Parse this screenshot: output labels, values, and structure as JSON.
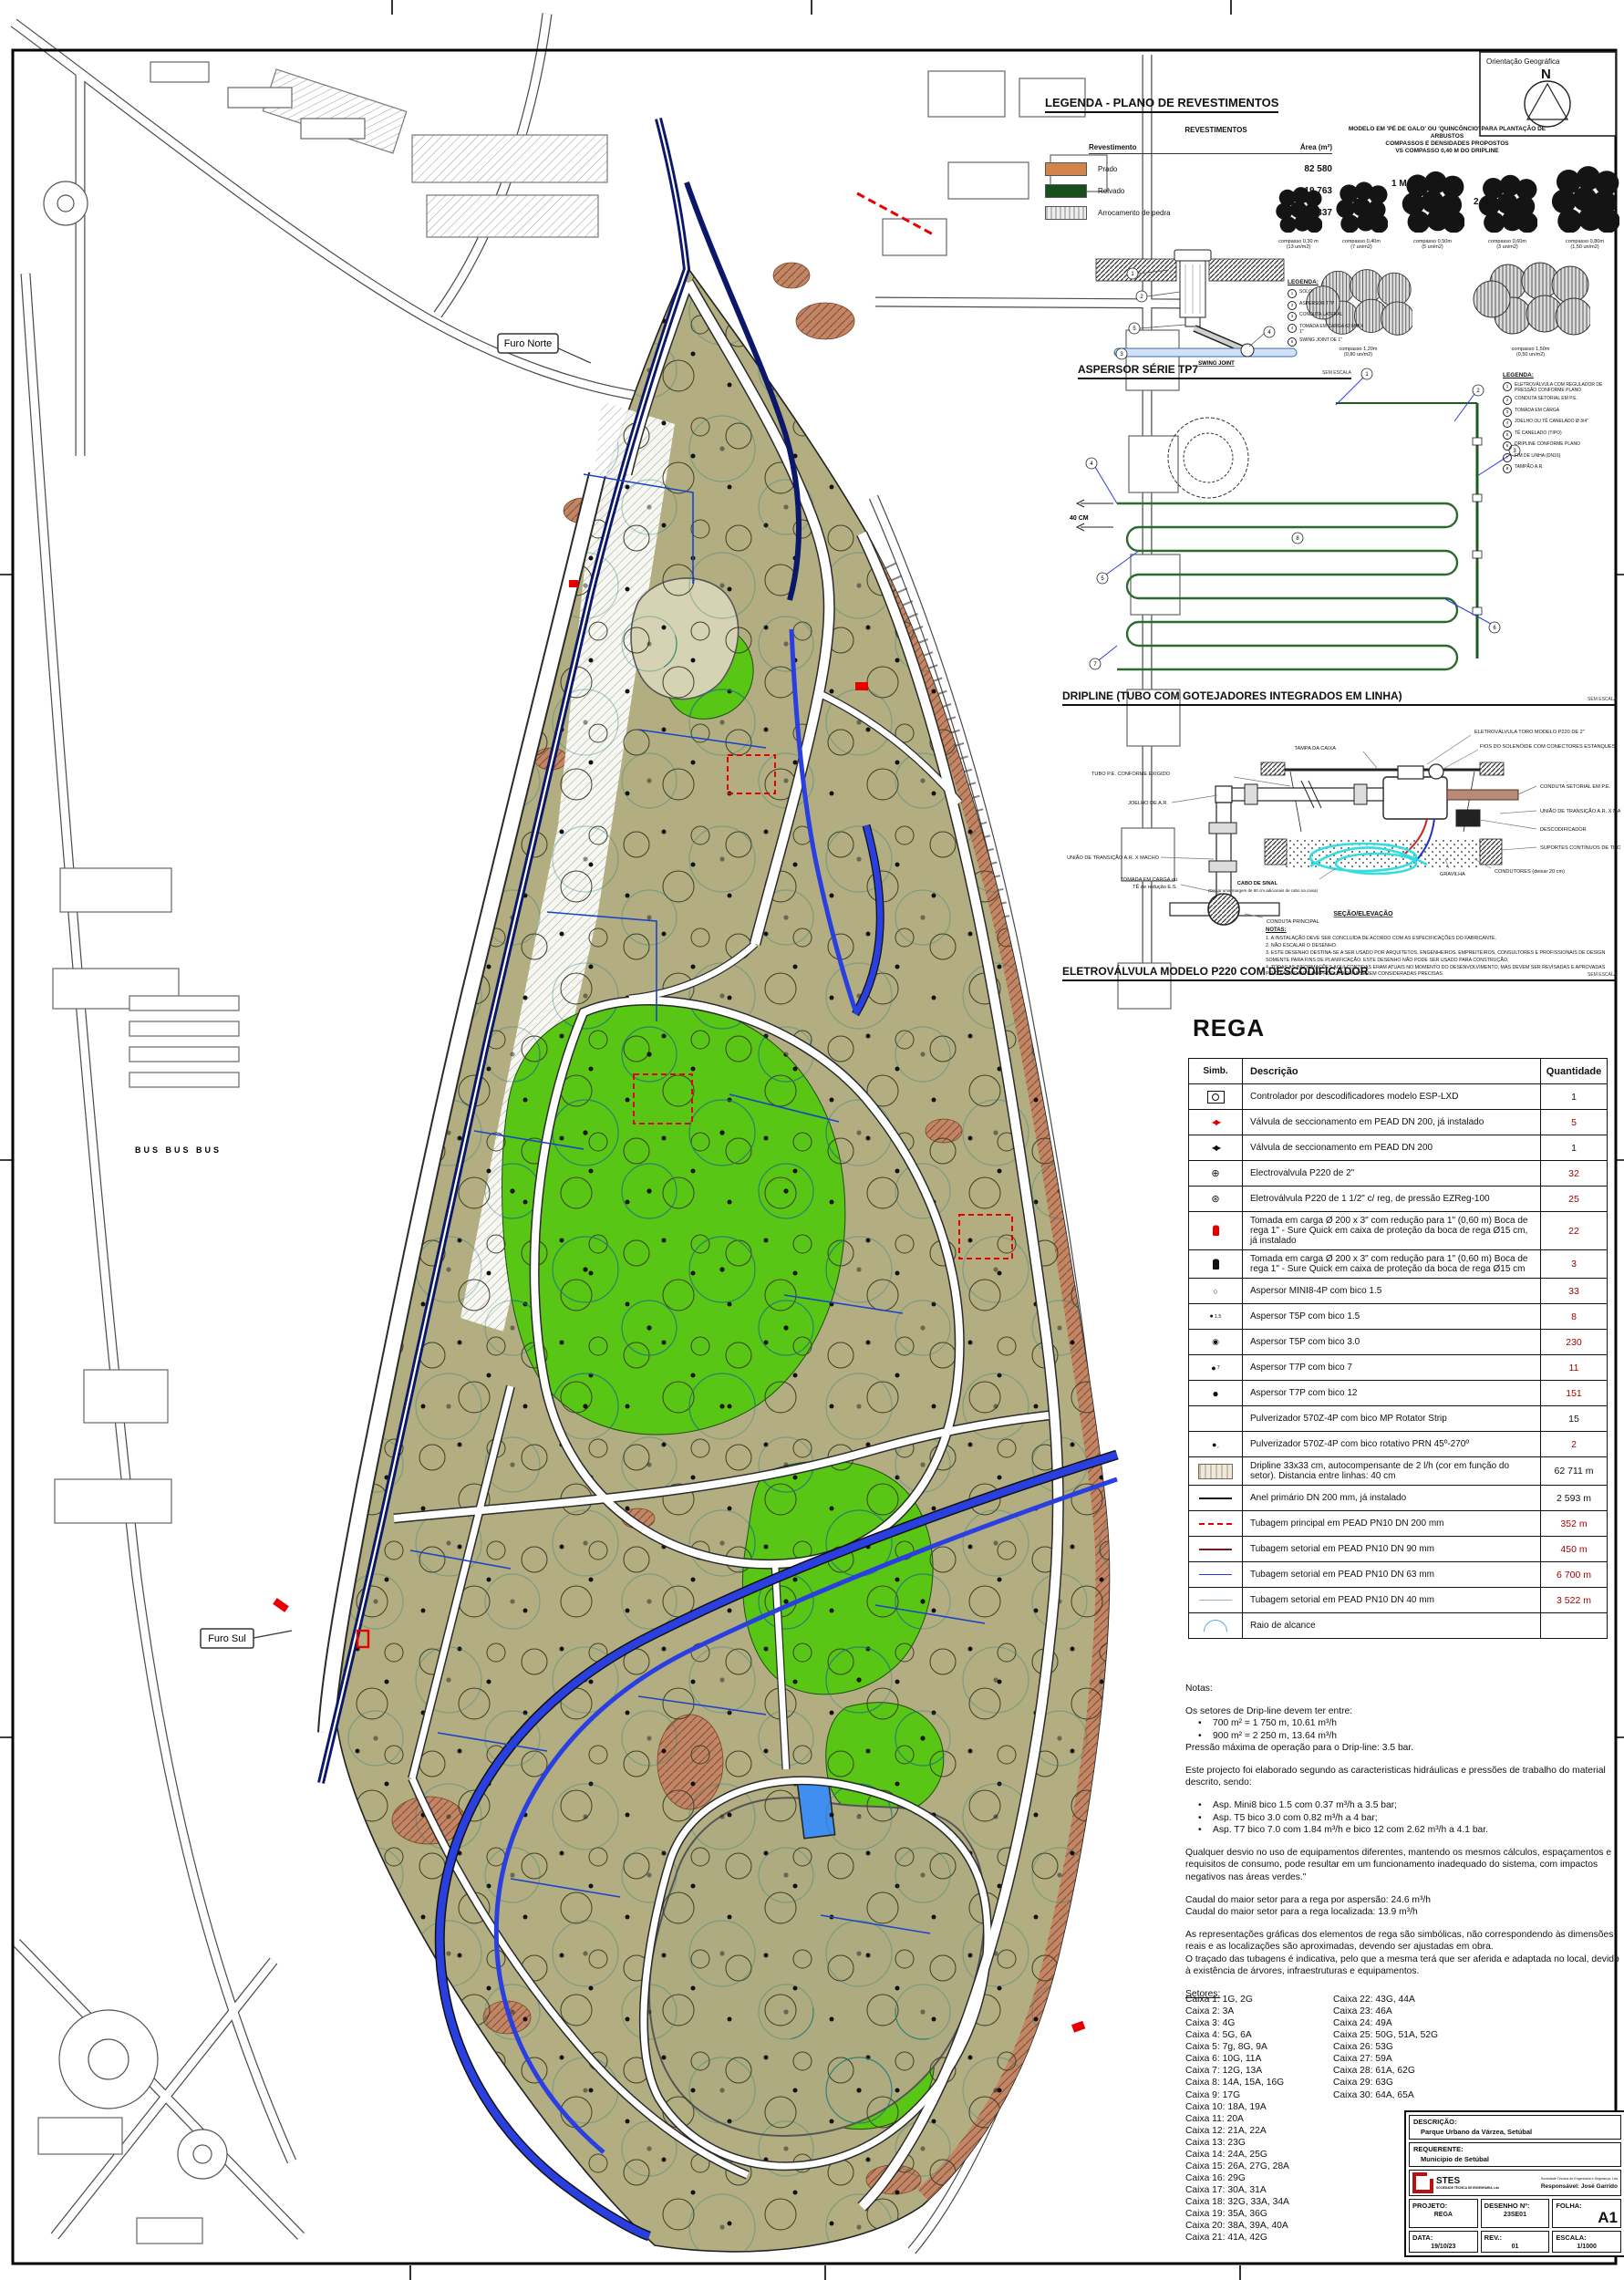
{
  "colors": {
    "olive": "#b2ae82",
    "relvado": "#59c515",
    "pipe_blue": "#2a3fe0",
    "anel_navy": "#0b1768",
    "tan": "#c08666",
    "teal": "#1f7a74",
    "red": "#e80000",
    "qty_red": "#a80000"
  },
  "map": {
    "furo_norte": "Furo Norte",
    "furo_sul": "Furo Sul",
    "bus": "BUS  BUS  BUS"
  },
  "compass": {
    "title": "Orientação Geográfica",
    "n": "N"
  },
  "legenda_rev": {
    "title": "LEGENDA - PLANO DE REVESTIMENTOS",
    "table_title": "REVESTIMENTOS",
    "col1": "Revestimento",
    "col2": "Área (m²)",
    "rows": [
      {
        "sw": "prado",
        "name": "Prado",
        "area": "82 580"
      },
      {
        "sw": "relvado",
        "name": "Relvado",
        "area": "19 763"
      },
      {
        "sw": "pedra",
        "name": "Arrocamento de pedra",
        "area": "6 337"
      }
    ]
  },
  "plant": {
    "title1": "MODELO  EM 'PÉ DE GALO' OU 'QUINCÔNCIO' PARA PLANTAÇÃO DE",
    "title2": "ARBUSTOS",
    "title3": "COMPASSOS E DENSIDADES PROPOSTOS",
    "title4": "VS COMPASSO 0,40 M DO DRIPLINE",
    "dim1": "1 M",
    "dim2": "2 M",
    "row1": [
      {
        "c": "compasso 0,30 m",
        "d": "(13 un/m2)",
        "w": "52"
      },
      {
        "c": "compasso 0,40m",
        "d": "(7 un/m2)",
        "w": "58"
      },
      {
        "c": "compasso 0,50m",
        "d": "(5 un/m2)",
        "w": "70"
      },
      {
        "c": "compasso 0,60m",
        "d": "(3 un/m2)",
        "w": "66"
      },
      {
        "c": "compasso 0,80m",
        "d": "(1,50 un/m2)",
        "w": "76"
      }
    ],
    "row2": [
      {
        "c": "compasso 1,20m",
        "d": "(0,80 un/m2)",
        "w": "118"
      },
      {
        "c": "compasso 1,50m",
        "d": "(0,50 un/m2)",
        "w": "130"
      }
    ]
  },
  "aspersor": {
    "title": "ASPERSOR SÉRIE TP7",
    "legend_title": "LEGENDA:",
    "swing": "SWING JOINT",
    "scale": "SEM ESCALA",
    "items": [
      {
        "n": "1",
        "t": "SOLO"
      },
      {
        "n": "2",
        "t": "ASPERSOR T7P"
      },
      {
        "n": "3",
        "t": "CONDUTA LATERAL"
      },
      {
        "n": "4",
        "t": "TOMADA EM CARGA 63 MM X 1\""
      },
      {
        "n": "5",
        "t": "SWING JOINT DE 1\""
      }
    ]
  },
  "dripline": {
    "title": "DRIPLINE  (TUBO COM GOTEJADORES INTEGRADOS EM LINHA)",
    "legend_title": "LEGENDA:",
    "dim": "40 CM",
    "scale": "SEM ESCALA",
    "items": [
      {
        "n": "1",
        "t": "ELETROVÁLVULA COM REGULADOR DE PRESSÃO CONFORME PLANO"
      },
      {
        "n": "2",
        "t": "CONDUTA SETORIAL EM P.E."
      },
      {
        "n": "3",
        "t": "TOMADA EM CARGA"
      },
      {
        "n": "4",
        "t": "JOELHO OU TÊ CANELADO Ø 3/4\""
      },
      {
        "n": "5",
        "t": "TÊ CANELADO (TIPO)"
      },
      {
        "n": "6",
        "t": "DRIPLINE CONFORME PLANO"
      },
      {
        "n": "7",
        "t": "FIM DE LINHA (DN16)"
      },
      {
        "n": "8",
        "t": "TAMPÃO A.R."
      }
    ]
  },
  "valve": {
    "title": "ELETROVÁLVULA MODELO P220 COM DESCODIFICADOR",
    "scale": "SEM ESCALA",
    "labels": [
      "TAMPA DA CAIXA",
      "ELETROVÁLVULA TORO  MODELO P220 DE 2\"",
      "FIOS DO SOLENÓIDE COM CONECTORES ESTANQUES",
      "TUBO P.E. CONFORME EXIGIDO",
      "JOELHO DE A.R.",
      "UNIÃO DE TRANSIÇÃO A.R. X MACHO",
      "TOMADA EM CARGA ou",
      "TÊ de redução E.S.",
      "CONDUTA PRINCIPAL",
      "CONDUTA SETORIAL EM P.E.",
      "UNIÃO DE TRANSIÇÃO A.R. X MACHO",
      "DESCODIFICADOR",
      "SUPORTES CONTÍNUOS DE TIJOLO",
      "CONDUTORES (deixar 20 cm)",
      "GRAVILHA",
      "CABO DE SINAL",
      "(Deixar uma margem de 80 cm adicionais de cabo na caixa)",
      "SEÇÃO/ELEVAÇÃO"
    ],
    "notes_title": "NOTAS:",
    "notes": [
      "1. A INSTALAÇÃO DEVE SER CONCLUÍDA DE ACORDO COM AS ESPECIFICAÇÕES DO FABRICANTE.",
      "2. NÃO ESCALAR O DESENHO.",
      "3. ESTE DESENHO DESTINA-SE A SER USADO POR ARQUITETOS, ENGENHEIROS, EMPREITEIROS, CONSULTORES E PROFISSIONAIS DE DESIGN SOMENTE PARA FINS DE PLANIFICAÇÃO. ESTE DESENHO NÃO PODE SER USADO PARA CONSTRUÇÃO.",
      "4. TODAS AS INFORMAÇÕES AQUI CONTIDAS ERAM ATUAIS NO MOMENTO DO DESENVOLVIMENTO, MAS DEVEM SER REVISADAS E APROVADAS PELO FABRICANTE DO PRODUTO PARA SEREM CONSIDERADAS PRECISAS."
    ]
  },
  "rega": {
    "title": "REGA",
    "headers": [
      "Simb.",
      "Descrição",
      "Quantidade"
    ],
    "rows": [
      {
        "sym": "controller",
        "desc": "Controlador por descodificadores modelo ESP-LXD",
        "qty": "1",
        "qc": "k"
      },
      {
        "sym": "valve-r",
        "desc": "Válvula de seccionamento em PEAD DN 200, já instalado",
        "qty": "5",
        "qc": "r"
      },
      {
        "sym": "valve-k",
        "desc": "Válvula de seccionamento em PEAD DN 200",
        "qty": "1",
        "qc": "k"
      },
      {
        "sym": "ev2",
        "desc": "Electrovalvula P220 de 2\"",
        "qty": "32",
        "qc": "r"
      },
      {
        "sym": "evreg",
        "desc": "Eletroválvula P220 de 1 1/2\" c/ reg, de pressão EZReg-100",
        "qty": "25",
        "qc": "r"
      },
      {
        "sym": "hyd-r",
        "desc": "Tomada em carga Ø 200 x 3\"  com redução para 1\" (0,60 m) Boca de rega 1\" - Sure Quick em caixa de proteção da boca de rega Ø15 cm, já instalado",
        "qty": "22",
        "qc": "r"
      },
      {
        "sym": "hyd-k",
        "desc": "Tomada em carga Ø 200 x 3\"  com redução para 1\" (0,60 m) Boca de rega 1\" - Sure Quick em caixa de proteção da boca de rega Ø15 cm",
        "qty": "3",
        "qc": "r"
      },
      {
        "sym": "mini8",
        "desc": "Aspersor MINI8-4P com bico 1.5",
        "qty": "33",
        "qc": "r"
      },
      {
        "sym": "t5p15",
        "desc": "Aspersor T5P com bico 1.5",
        "qty": "8",
        "qc": "r"
      },
      {
        "sym": "t5p30",
        "desc": "Aspersor T5P com bico 3.0",
        "qty": "230",
        "qc": "r"
      },
      {
        "sym": "t7p7",
        "desc": "Aspersor T7P com bico 7",
        "qty": "11",
        "qc": "r"
      },
      {
        "sym": "t7p12",
        "desc": "Aspersor T7P com bico 12",
        "qty": "151",
        "qc": "r"
      },
      {
        "sym": "none",
        "desc": "Pulverizador 570Z-4P com bico MP Rotator Strip",
        "qty": "15",
        "qc": "k"
      },
      {
        "sym": "prn",
        "desc": "Pulverizador 570Z-4P com bico rotativo PRN 45º-270º",
        "qty": "2",
        "qc": "r"
      },
      {
        "sym": "drip",
        "desc": "Dripline 33x33 cm, autocompensante de 2 l/h (cor em função do setor). Distancia entre linhas: 40 cm",
        "qty": "62 711 m",
        "qc": "k"
      },
      {
        "sym": "ln-k",
        "desc": "Anel primário DN 200 mm, já instalado",
        "qty": "2 593 m",
        "qc": "k"
      },
      {
        "sym": "ln-rd",
        "desc": "Tubagem principal em PEAD PN10 DN 200 mm",
        "qty": "352 m",
        "qc": "r"
      },
      {
        "sym": "ln-dr",
        "desc": "Tubagem setorial em PEAD PN10 DN 90 mm",
        "qty": "450 m",
        "qc": "r"
      },
      {
        "sym": "ln-b",
        "desc": "Tubagem setorial em PEAD PN10 DN 63 mm",
        "qty": "6 700 m",
        "qc": "r"
      },
      {
        "sym": "ln-g",
        "desc": "Tubagem setorial em PEAD PN10 DN 40 mm",
        "qty": "3 522 m",
        "qc": "r"
      },
      {
        "sym": "raio",
        "desc": "Raio de alcance",
        "qty": "",
        "qc": "k"
      }
    ]
  },
  "notas": [
    {
      "t": "Notas:"
    },
    {
      "t": "Os setores de Drip-line devem ter entre:",
      "top": "1"
    },
    {
      "t": "700 m² = 1 750 m, 10.61 m³/h",
      "b": "1"
    },
    {
      "t": "900 m² = 2 250 m, 13.64 m³/h",
      "b": "1"
    },
    {
      "t": "Pressão máxima de operação para o Drip-line: 3.5 bar."
    },
    {
      "t": "Este projecto foi elaborado segundo as caracteristicas hidráulicas e pressões de trabalho do material descrito, sendo:",
      "top": "1"
    },
    {
      "t": "Asp. Mini8 bico 1.5 com 0.37 m³/h a 3.5 bar;",
      "b": "1",
      "top": "1"
    },
    {
      "t": "Asp. T5 bico 3.0 com 0.82 m³/h a 4 bar;",
      "b": "1"
    },
    {
      "t": "Asp. T7 bico 7.0 com 1.84 m³/h e bico 12 com 2.62 m³/h a 4.1 bar.",
      "b": "1"
    },
    {
      "t": "Qualquer desvio no uso de equipamentos diferentes, mantendo os mesmos cálculos, espaçamentos e requisitos de consumo, pode resultar em um funcionamento inadequado do sistema, com impactos negativos nas áreas verdes.\"",
      "top": "1"
    },
    {
      "t": "Caudal do maior setor para a rega por aspersão: 24.6 m³/h",
      "top": "1"
    },
    {
      "t": "Caudal do maior setor para a rega localizada: 13.9 m³/h"
    },
    {
      "t": "As representações gráficas dos elementos de rega são simbólicas, não correspondendo às dimensões reais e as localizações são aproximadas, devendo ser ajustadas em obra.",
      "top": "1"
    },
    {
      "t": "O traçado das tubagens é indicativa, pelo que a mesma terá que ser aferida e adaptada no local, devido à existência de árvores, infraestruturas e equipamentos."
    },
    {
      "t": "Setores:",
      "u": "1",
      "top": "1"
    }
  ],
  "setores": {
    "col1": [
      "Caixa 1: 1G, 2G",
      "Caixa 2: 3A",
      "Caixa 3: 4G",
      "Caixa 4: 5G, 6A",
      "Caixa 5: 7g, 8G, 9A",
      "Caixa 6: 10G, 11A",
      "Caixa 7: 12G, 13A",
      "Caixa 8: 14A, 15A, 16G",
      "Caixa 9: 17G",
      "Caixa 10: 18A, 19A",
      "Caixa 11: 20A",
      "Caixa 12: 21A, 22A",
      "Caixa 13: 23G",
      "Caixa 14: 24A, 25G",
      "Caixa 15: 26A, 27G, 28A",
      "Caixa 16: 29G",
      "Caixa 17: 30A, 31A",
      "Caixa 18: 32G, 33A, 34A",
      "Caixa 19: 35A, 36G",
      "Caixa 20: 38A, 39A, 40A",
      "Caixa 21: 41A, 42G"
    ],
    "col2": [
      "Caixa 22: 43G, 44A",
      "Caixa 23: 46A",
      "Caixa 24: 49A",
      "Caixa 25: 50G, 51A, 52G",
      "Caixa 26: 53G",
      "Caixa 27: 59A",
      "Caixa 28: 61A, 62G",
      "Caixa 29: 63G",
      "Caixa 30: 64A, 65A"
    ]
  },
  "tblock": {
    "desc_label": "DESCRIÇÃO:",
    "desc": "Parque Urbano da Várzea, Setúbal",
    "req_label": "REQUERENTE:",
    "req": "Municipio de Setúbal",
    "logo_name": "STES",
    "logo_sub": "SOCIEDADE TÉCNICA DE ENGENHARIA, Lda",
    "partner": "- Sociedade Técnica de Engenharia e Segurança, Lda",
    "resp": "Responsável: José Garrido",
    "proj_label": "PROJETO:",
    "proj": "REGA",
    "des_label": "DESENHO Nº:",
    "des": "23SE01",
    "folha_label": "FOLHA:",
    "folha": "A1",
    "data_label": "DATA:",
    "data": "19/10/23",
    "rev_label": "REV.:",
    "rev": "01",
    "esc_label": "ESCALA:",
    "esc": "1/1000"
  }
}
